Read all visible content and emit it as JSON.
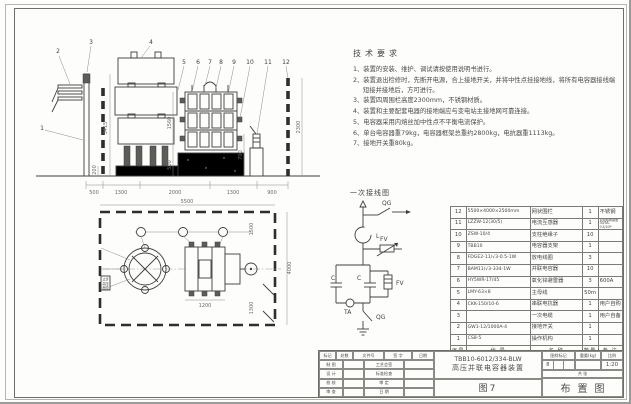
{
  "notes": {
    "title": "技术要求",
    "items": [
      "1、装置的安装、维护、调试请按使用说明书进行。",
      "2、装置退出检修时，先断开电源，合上接地开关，并将中性点挂接地线，将所有电容器接线端短接并接地后，方可进行。",
      "3、装置四周围栏高度2300mm，不锈钢材质。",
      "4、装置和主要配套电器的接地端应与变电站主接地网可靠连接。",
      "5、电容器采用内熔丝加中性点不平衡电流保护。",
      "6、单台电容器重79kg，电容器框架总重约2800kg，电抗器重1113kg。",
      "7、接地开关重80kg。"
    ]
  },
  "front_view": {
    "callouts": [
      "1",
      "2",
      "3",
      "4",
      "5",
      "6",
      "7",
      "8",
      "9",
      "10",
      "11",
      "12"
    ],
    "dims": {
      "pole_height": "3415",
      "rack_height": "1560",
      "plinth": "500",
      "device": "700",
      "fence": "2300",
      "base": "200"
    },
    "bottom_dims": [
      "500",
      "1300",
      "2000",
      "1300",
      "900"
    ]
  },
  "plan_view": {
    "dims": {
      "width": "5500",
      "depth": "4000",
      "top_gap": "1500",
      "bank": "1100",
      "bottom_gap": "1300",
      "bank_width": "1200"
    },
    "sign_lines": [
      "止步",
      "高压",
      "危险"
    ]
  },
  "circuit": {
    "title": "一次接线图",
    "labels": {
      "qg_top": "QG",
      "reactor": "L",
      "arrester_top": "FV",
      "cap_left": "C",
      "cap_right": "C",
      "arrester_right": "FV",
      "ct": "TA",
      "qg_bottom": "QG"
    }
  },
  "parts_table": {
    "headers": {
      "no": "序号",
      "model": "代  号",
      "name": "名  称",
      "qty": "数量",
      "note": "备 注"
    },
    "rows": [
      {
        "no": "12",
        "model": "5500×4000×2500mm",
        "name": "网状围栏",
        "qty": "1",
        "note": "不锈钢"
      },
      {
        "no": "11",
        "model": "LZZW-12(30/5)",
        "name": "电流互感器",
        "qty": "1",
        "note": "双绕组同容量 30/5A-0.5/10P"
      },
      {
        "no": "10",
        "model": "ZSW-10/4",
        "name": "支柱绝缘子",
        "qty": "10",
        "note": ""
      },
      {
        "no": "9",
        "model": "TBB10",
        "name": "电容器支架",
        "qty": "1",
        "note": ""
      },
      {
        "no": "8",
        "model": "FDGE2-11/√3-0.5-1W",
        "name": "放电线圈",
        "qty": "3",
        "note": ""
      },
      {
        "no": "7",
        "model": "BAM11/√3-334-1W",
        "name": "并联电容器",
        "qty": "10",
        "note": ""
      },
      {
        "no": "6",
        "model": "HY5WR-17/45",
        "name": "氧化锌避雷器",
        "qty": "3",
        "note": "600A"
      },
      {
        "no": "5",
        "model": "LMY-63×8",
        "name": "主母线",
        "qty": "50m",
        "note": ""
      },
      {
        "no": "4",
        "model": "CKK-150/10-6",
        "name": "串联电抗器",
        "qty": "1",
        "note": "用户自购"
      },
      {
        "no": "3",
        "model": "",
        "name": "一次电缆",
        "qty": "1",
        "note": "用户自备"
      },
      {
        "no": "2",
        "model": "GW1-12/1000A-4",
        "name": "接地开关",
        "qty": "1",
        "note": ""
      },
      {
        "no": "1",
        "model": "CS8-5",
        "name": "操作机构",
        "qty": "1",
        "note": ""
      }
    ]
  },
  "title_block": {
    "model": "TBB10-6012/334-BLW",
    "product_name": "高压并联电容器装置",
    "figure_label": "图7",
    "drawing_title": "布置图",
    "mark_label": "图样标记",
    "weight_label": "重量(kg)",
    "scale_label": "比例",
    "scale_value": "1:20",
    "stage_value": "8",
    "sheets_total": "共  张",
    "header_cells": [
      "标记",
      "处数",
      "文件号",
      "签 字",
      "日期"
    ],
    "sign_rows": [
      {
        "left": "制 图",
        "right": "工艺会签"
      },
      {
        "left": "设 计",
        "right": "标准检查"
      },
      {
        "left": "校 核",
        "right": "审  定"
      },
      {
        "left": "审 查",
        "right": "日  期"
      }
    ]
  }
}
